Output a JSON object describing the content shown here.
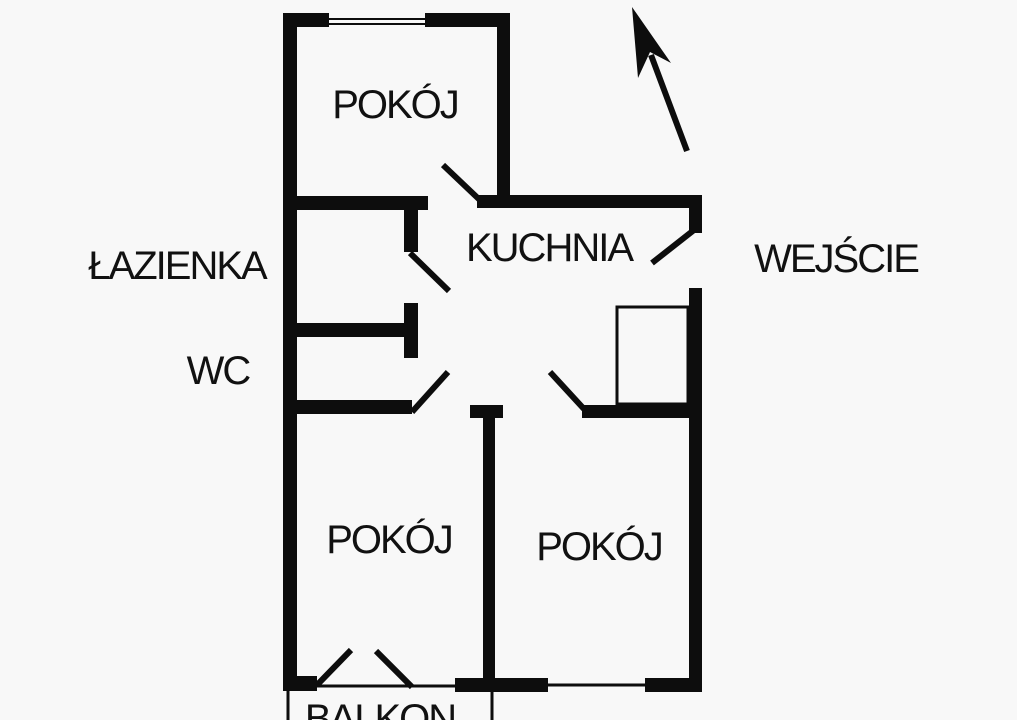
{
  "plan": {
    "rooms": [
      {
        "id": "pokoj-top",
        "label": "POKÓJ"
      },
      {
        "id": "kuchnia",
        "label": "KUCHNIA"
      },
      {
        "id": "lazienka",
        "label": "ŁAZIENKA"
      },
      {
        "id": "wc",
        "label": "WC"
      },
      {
        "id": "pokoj-left",
        "label": "POKÓJ"
      },
      {
        "id": "pokoj-right",
        "label": "POKÓJ"
      },
      {
        "id": "balkon",
        "label": "BALKON"
      }
    ],
    "entrance": {
      "label": "WEJŚCIE"
    },
    "icons": {
      "north_arrow": "north-arrow"
    },
    "colors": {
      "background": "#f8f8f8",
      "wall": "#0d0d0d",
      "text": "#111111"
    }
  }
}
